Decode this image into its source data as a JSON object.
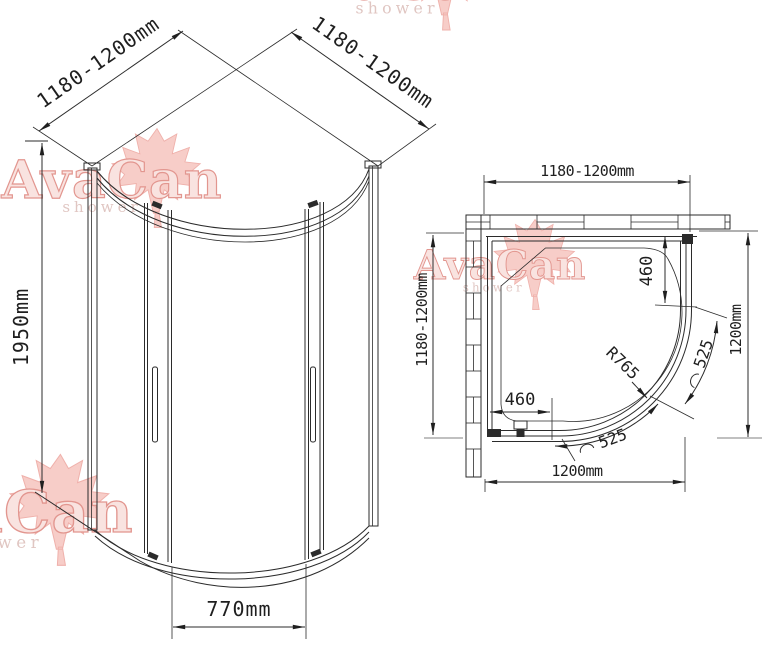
{
  "watermark": {
    "brand": "AvaCan",
    "subtitle": "shower",
    "brand_fill": "#f8ddd9",
    "brand_stroke": "#dc7c74",
    "subtitle_color": "#d9b8b3",
    "leaf_fill": "#f6c1bb",
    "leaf_stroke": "#ec9e97"
  },
  "front_view": {
    "dims": {
      "top_left_width": "1180-1200mm",
      "top_right_width": "1180-1200mm",
      "height": "1950mm",
      "door_opening_width": "770mm"
    }
  },
  "plan_view": {
    "dims": {
      "top_width": "1180-1200mm",
      "left_depth": "1180-1200mm",
      "right_depth": "1200mm",
      "bottom_width": "1200mm",
      "side_panel_top": "460",
      "side_panel_bottom": "460",
      "door_radius": "R765",
      "door_arc_upper": "525",
      "door_arc_lower": "525"
    }
  }
}
